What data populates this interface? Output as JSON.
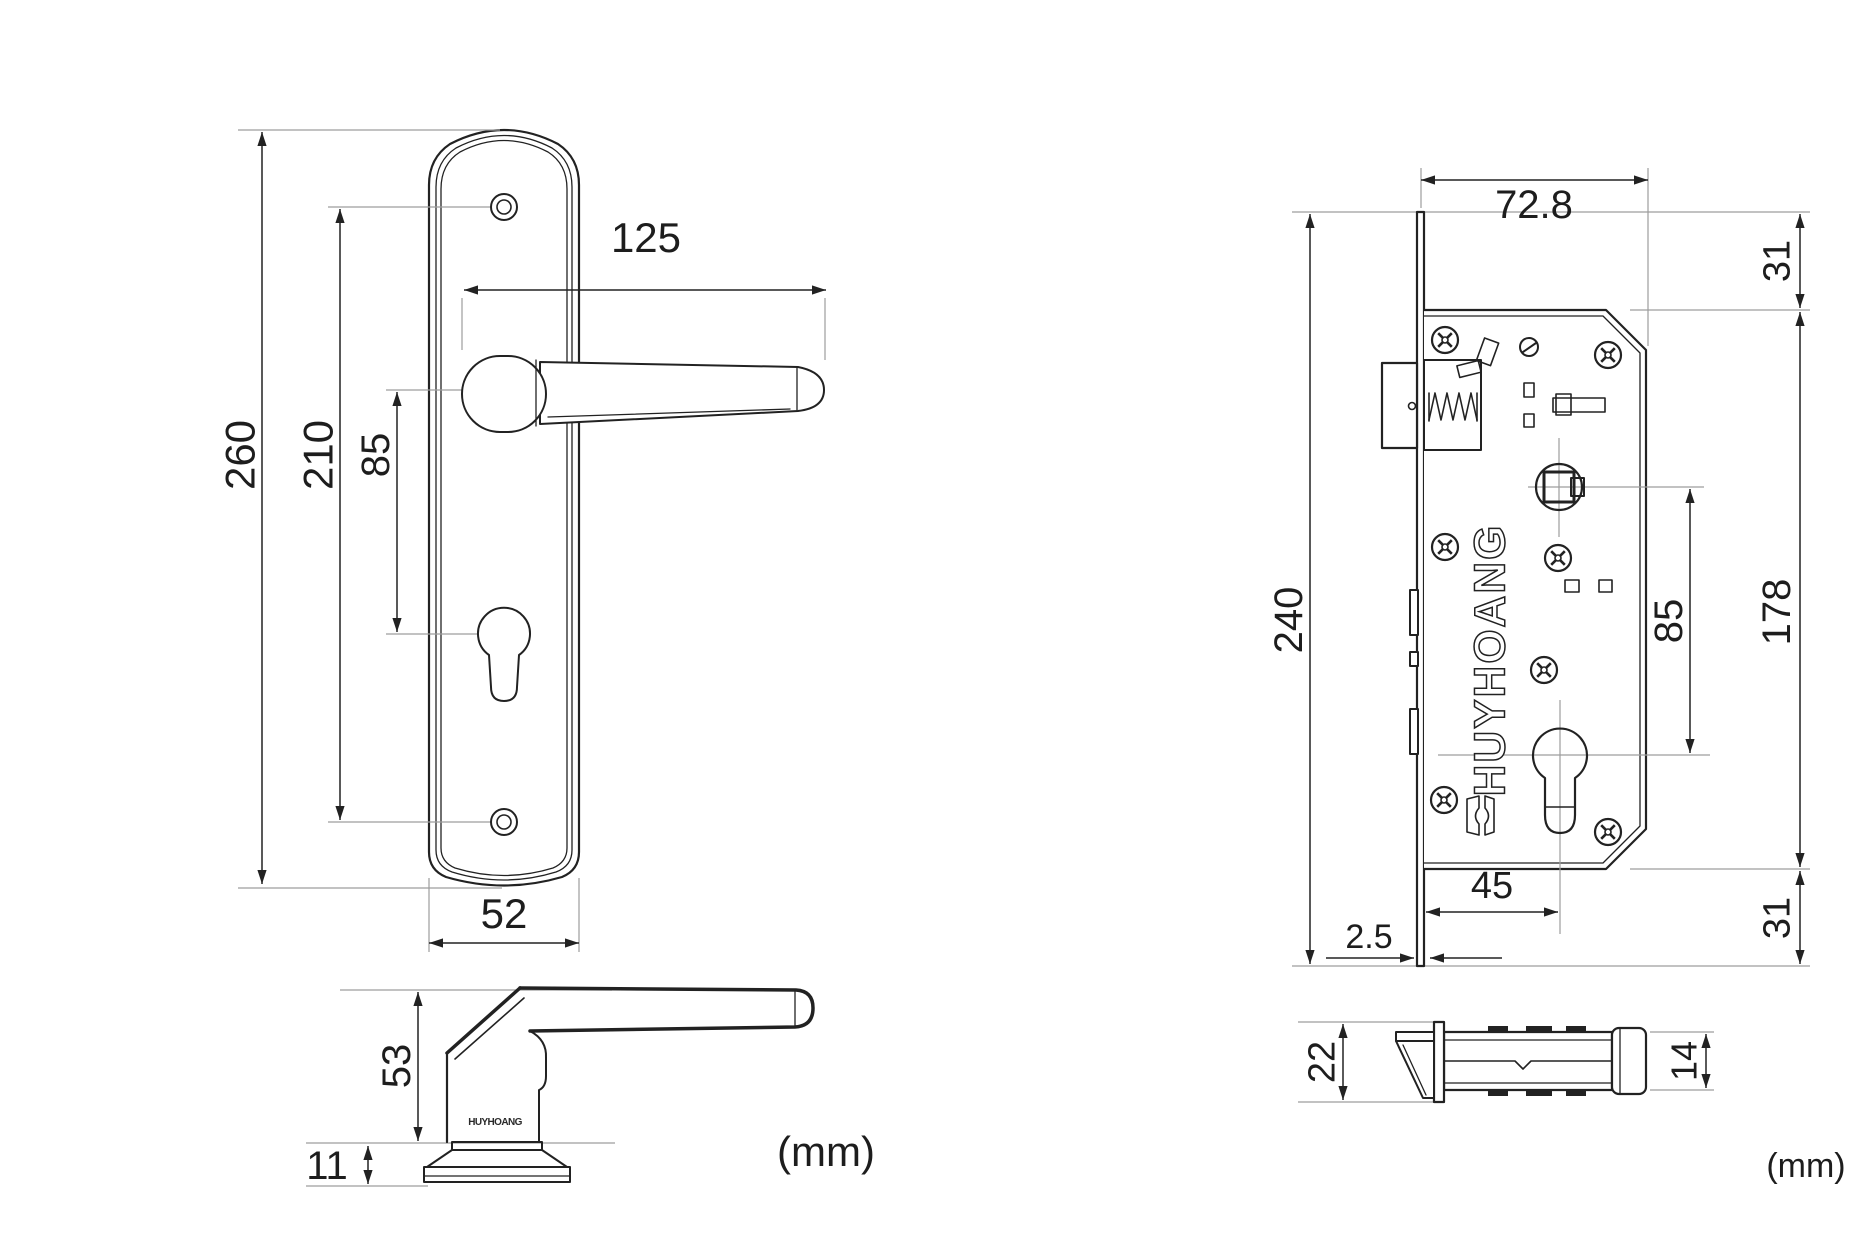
{
  "views": {
    "handle_front": {
      "total_height": "260",
      "screw_spacing": "210",
      "lever_to_keyhole": "85",
      "lever_length": "125",
      "plate_width": "52"
    },
    "handle_side": {
      "height": "53",
      "base_height": "11",
      "engraving": "HUYHOANG"
    },
    "lock_front": {
      "case_width": "72.8",
      "top_offset": "31",
      "faceplate_height": "240",
      "case_height": "178",
      "spindle_to_cylinder": "85",
      "backset": "45",
      "faceplate_thickness": "2.5",
      "bottom_offset": "31",
      "brand": "HUYHOANG"
    },
    "lock_side": {
      "faceplate_width": "22",
      "case_thickness": "14"
    },
    "units": {
      "left_label": "(mm)",
      "right_label": "(mm)"
    }
  }
}
